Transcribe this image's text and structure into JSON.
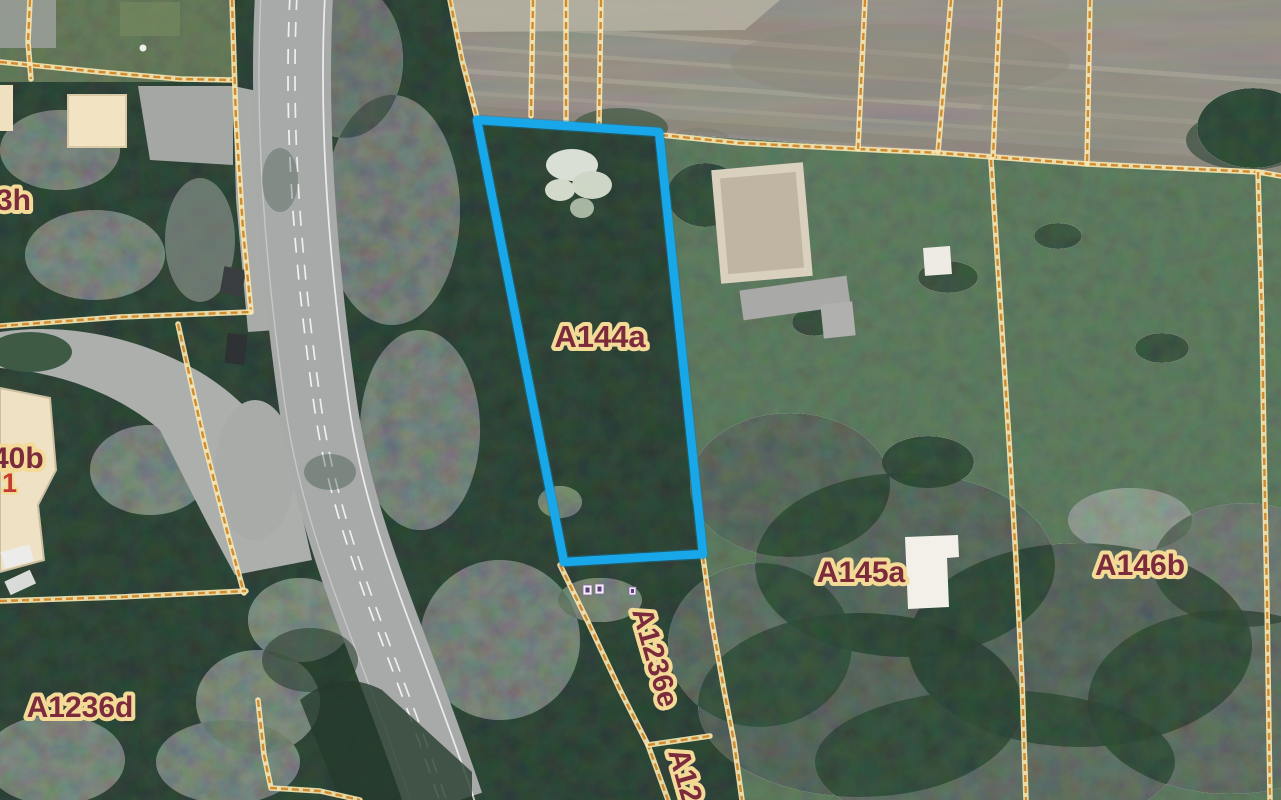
{
  "map": {
    "type": "aerial-cadastral-map",
    "colors": {
      "boundary_core": "#d28a2e",
      "boundary_halo": "#f6e6b0",
      "selected": "#18a8ea",
      "selected_halo": "#0e7fb5",
      "label_text": "#7b2b3c",
      "label_halo": "#f3da96",
      "house_number": "#c23b35"
    },
    "selected_parcel": {
      "label": "A144a",
      "points": "477,120 659,132 703,554 564,562"
    },
    "labels": [
      {
        "id": "parcel-label-a144a",
        "text": "A144a",
        "x": 600,
        "y": 347,
        "size": 31
      },
      {
        "id": "parcel-label-a145a",
        "text": "A145a",
        "x": 861,
        "y": 582,
        "size": 30
      },
      {
        "id": "parcel-label-a146b",
        "text": "A146b",
        "x": 1140,
        "y": 575,
        "size": 30
      },
      {
        "id": "parcel-label-a1236d",
        "text": "A1236d",
        "x": 80,
        "y": 717,
        "size": 30
      },
      {
        "id": "parcel-label-a1236e",
        "text": "A1236e",
        "x": 646,
        "y": 660,
        "size": 29,
        "rotate": 74
      },
      {
        "id": "parcel-label-a12-truncated",
        "text": "A12",
        "x": 668,
        "y": 752,
        "size": 30,
        "rotate": 74,
        "anchor": "start"
      },
      {
        "id": "parcel-label-3h",
        "text": "3h",
        "x": -4,
        "y": 210,
        "size": 30,
        "anchor": "start"
      },
      {
        "id": "parcel-label-40b",
        "text": "40b",
        "x": -8,
        "y": 468,
        "size": 30,
        "anchor": "start"
      },
      {
        "id": "house-number-1",
        "text": "1",
        "x": 2,
        "y": 492,
        "size": 27,
        "anchor": "start",
        "color": "#c23b35",
        "halo_width": 5
      }
    ],
    "boundaries": [
      {
        "name": "boundary-nw-horizontal",
        "points": "0,62 100,72 180,79 233,80"
      },
      {
        "name": "boundary-nw-vertical",
        "points": "30,0 28,42 31,79"
      },
      {
        "name": "boundary-west-vertical",
        "points": "232,0 236,120 243,230 251,312"
      },
      {
        "name": "boundary-west-horizontal",
        "points": "0,326 120,317 251,312"
      },
      {
        "name": "boundary-west-diagonal",
        "points": "178,324 205,445 228,535 244,593"
      },
      {
        "name": "boundary-sw-horizontal",
        "points": "0,601 120,597 246,591"
      },
      {
        "name": "boundary-sw-corner",
        "points": "258,700 264,755 271,788 320,791 360,800"
      },
      {
        "name": "boundary-field-west",
        "points": "450,0 462,60 477,118"
      },
      {
        "name": "boundary-field-1",
        "points": "533,0 531,116"
      },
      {
        "name": "boundary-field-2",
        "points": "566,0 566,121"
      },
      {
        "name": "boundary-field-3",
        "points": "601,0 599,125"
      },
      {
        "name": "boundary-main-east-west",
        "points": "661,135 740,143 858,149 940,153 993,157 1087,164 1258,172 1281,176"
      },
      {
        "name": "boundary-field-4",
        "points": "865,0 858,149"
      },
      {
        "name": "boundary-field-5",
        "points": "951,0 938,152"
      },
      {
        "name": "boundary-field-6",
        "points": "1000,0 993,157"
      },
      {
        "name": "boundary-field-7",
        "points": "1090,0 1087,164"
      },
      {
        "name": "boundary-east-vertical",
        "points": "1258,172 1262,320 1264,450 1267,600 1270,800"
      },
      {
        "name": "boundary-a145a-a146b",
        "points": "991,160 1000,300 1009,440 1016,560 1022,680 1026,800"
      },
      {
        "name": "boundary-a1236e-west",
        "points": "560,565 588,622 620,690 648,745 668,800"
      },
      {
        "name": "boundary-a1236e-east",
        "points": "703,557 712,622 724,690 734,742 742,800"
      },
      {
        "name": "boundary-a1236e-south",
        "points": "648,745 710,736"
      }
    ]
  }
}
